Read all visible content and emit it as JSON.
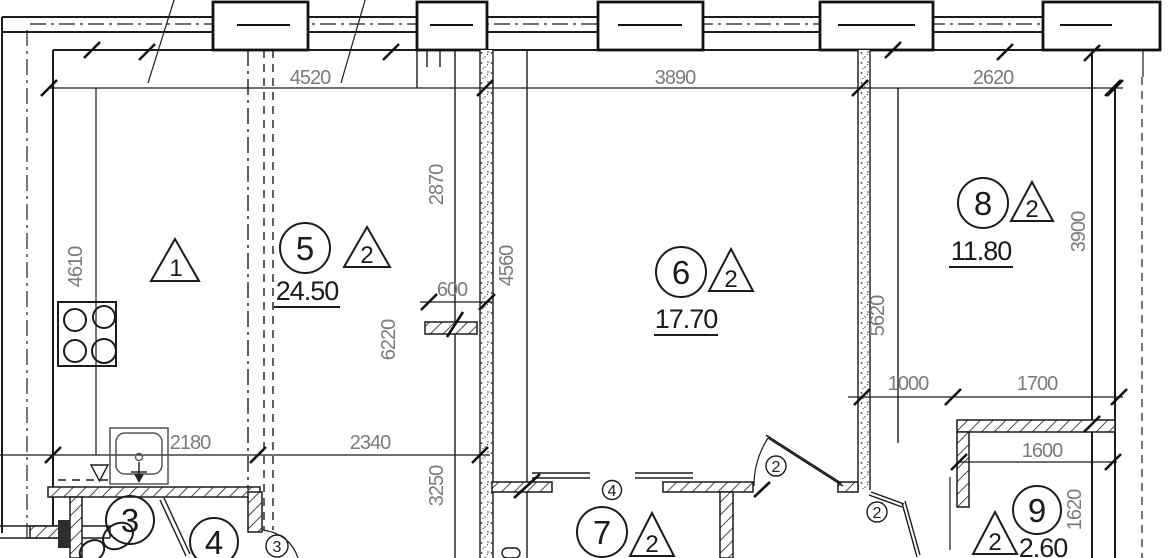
{
  "dims": {
    "d4520": "4520",
    "d3890": "3890",
    "d2620": "2620",
    "d4610": "4610",
    "d2870": "2870",
    "d4560": "4560",
    "d6220": "6220",
    "d600": "600",
    "d3250": "3250",
    "d2340": "2340",
    "d2180": "2180",
    "d5620": "5620",
    "d3900": "3900",
    "d1000": "1000",
    "d1700": "1700",
    "d1600": "1600",
    "d1620": "1620"
  },
  "rooms": {
    "r1": {
      "tri": "1"
    },
    "r3": {
      "num": "3"
    },
    "r4": {
      "num": "4"
    },
    "r5": {
      "num": "5",
      "area": "24.50",
      "tri": "2"
    },
    "r6": {
      "num": "6",
      "area": "17.70",
      "tri": "2"
    },
    "r7": {
      "num": "7",
      "tri": "2",
      "sub": "4"
    },
    "r8": {
      "num": "8",
      "area": "11.80",
      "tri": "2"
    },
    "r9": {
      "num": "9",
      "area": "2.60",
      "tri": "2"
    }
  },
  "door_markers": {
    "a": "2",
    "b": "2",
    "c": "3"
  }
}
